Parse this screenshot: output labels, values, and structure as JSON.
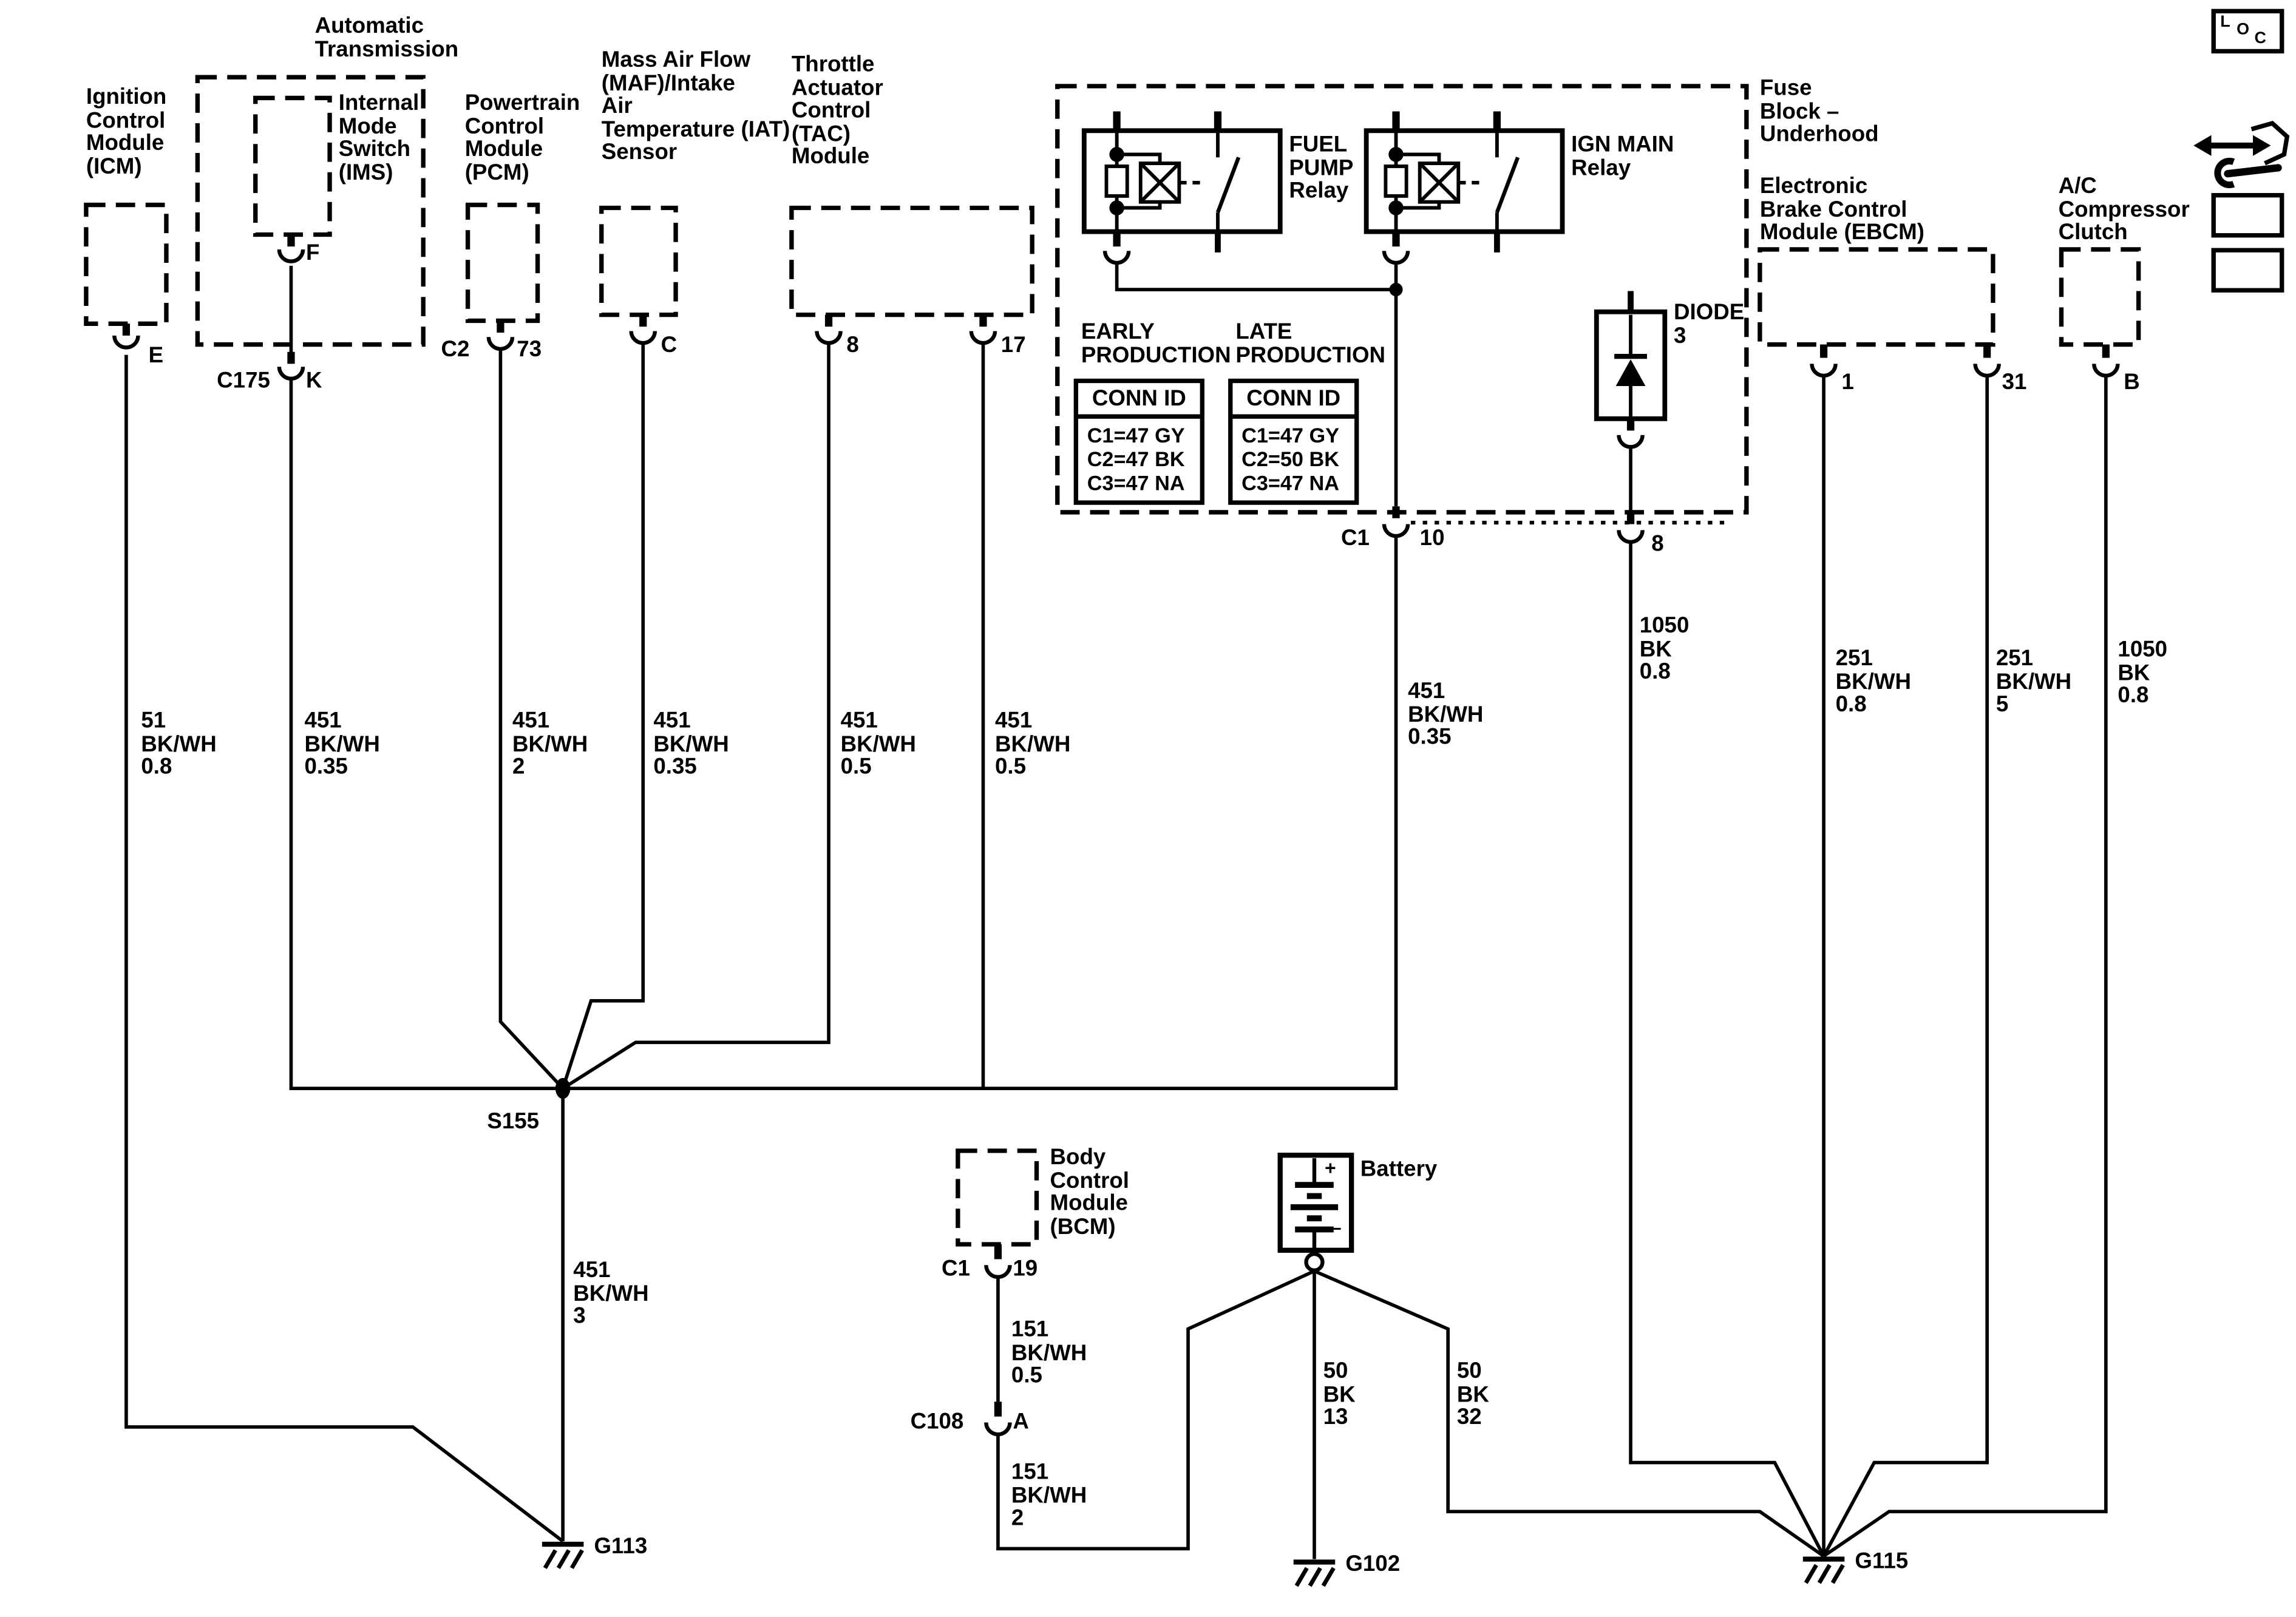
{
  "labels": {
    "icm": "Ignition\nControl\nModule\n(ICM)",
    "auto_trans": "Automatic\nTransmission",
    "ims": "Internal\nMode\nSwitch\n(IMS)",
    "pcm": "Powertrain\nControl\nModule\n(PCM)",
    "maf": "Mass Air Flow\n(MAF)/Intake\nAir\nTemperature (IAT)\nSensor",
    "tac": "Throttle\nActuator\nControl\n(TAC)\nModule",
    "fuel_pump_relay": "FUEL\nPUMP\nRelay",
    "ign_main_relay": "IGN MAIN\nRelay",
    "fuse_block": "Fuse\nBlock –\nUnderhood",
    "diode": "DIODE\n3",
    "ebcm": "Electronic\nBrake Control\nModule (EBCM)",
    "ac_clutch": "A/C\nCompressor\nClutch",
    "early_production": "EARLY\nPRODUCTION",
    "late_production": "LATE\nPRODUCTION",
    "bcm": "Body\nControl\nModule\n(BCM)",
    "battery": "Battery",
    "battery_plus": "+",
    "battery_minus": "–",
    "pin_e": "E",
    "pin_f": "F",
    "c175": "C175",
    "pin_k": "K",
    "c2": "C2",
    "pin_73": "73",
    "pin_c": "C",
    "pin_8_tac": "8",
    "pin_17": "17",
    "c1_fuse": "C1",
    "pin_10": "10",
    "pin_8_diode": "8",
    "pin_1": "1",
    "pin_31": "31",
    "pin_b": "B",
    "c1_bcm": "C1",
    "pin_19": "19",
    "c108": "C108",
    "pin_a": "A",
    "w_51": "51\nBK/WH\n0.8",
    "w_451_035_ims": "451\nBK/WH\n0.35",
    "w_451_2": "451\nBK/WH\n2",
    "w_451_035_maf": "451\nBK/WH\n0.35",
    "w_451_05_a": "451\nBK/WH\n0.5",
    "w_451_05_b": "451\nBK/WH\n0.5",
    "w_451_035_c1": "451\nBK/WH\n0.35",
    "w_1050_08_diode": "1050\nBK\n0.8",
    "w_251_08": "251\nBK/WH\n0.8",
    "w_251_5": "251\nBK/WH\n5",
    "w_1050_08_ac": "1050\nBK\n0.8",
    "w_451_3": "451\nBK/WH\n3",
    "w_151_05": "151\nBK/WH\n0.5",
    "w_151_2": "151\nBK/WH\n2",
    "w_50_13": "50\nBK\n13",
    "w_50_32": "50\nBK\n32",
    "s155": "S155",
    "g113": "G113",
    "g102": "G102",
    "g115": "G115",
    "loc_l": "L",
    "loc_o": "O",
    "loc_c": "C"
  },
  "tables": {
    "early": {
      "header": "CONN ID",
      "rows": [
        "C1=47 GY",
        "C2=47 BK",
        "C3=47 NA"
      ]
    },
    "late": {
      "header": "CONN ID",
      "rows": [
        "C1=47 GY",
        "C2=50 BK",
        "C3=47 NA"
      ]
    }
  }
}
